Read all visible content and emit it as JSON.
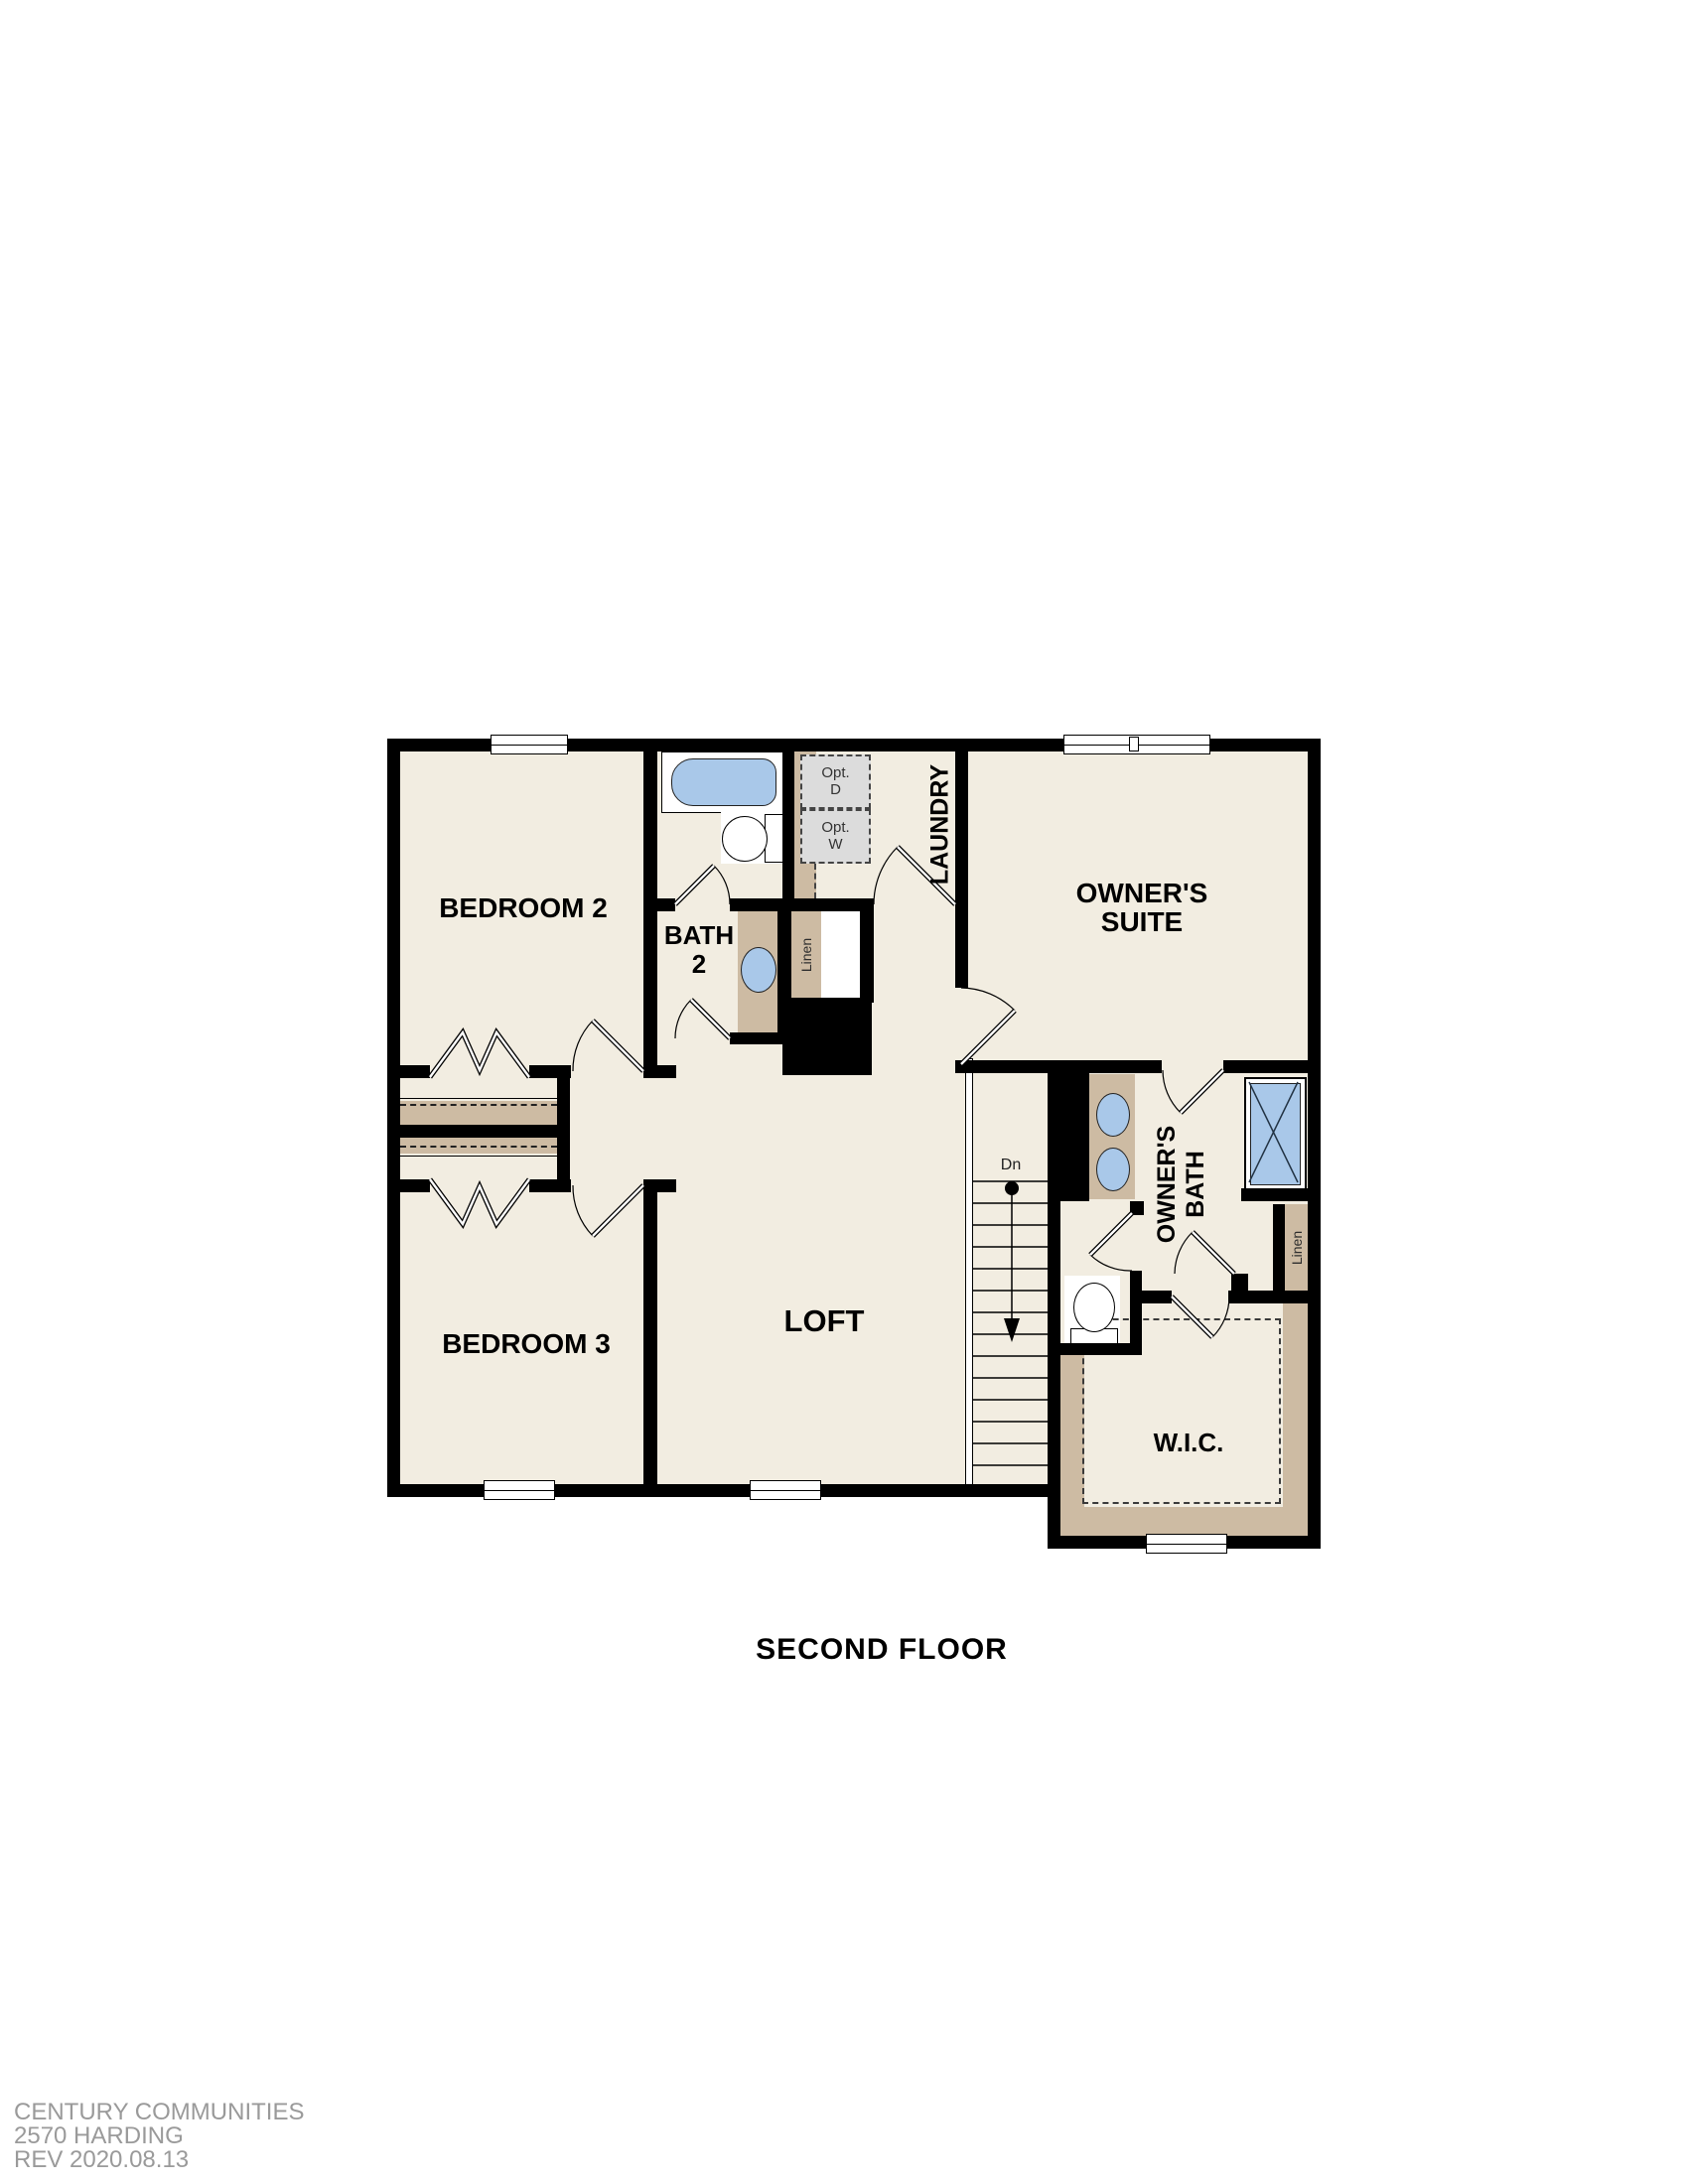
{
  "title": "SECOND FLOOR",
  "rooms": {
    "bedroom2": "BEDROOM 2",
    "bath2": "BATH 2",
    "laundry": "LAUNDRY",
    "owners_suite": "OWNER'S SUITE",
    "bedroom3": "BEDROOM 3",
    "loft": "LOFT",
    "owners_bath": "OWNER'S BATH",
    "wic": "W.I.C."
  },
  "closets": {
    "linen_bath2": "Linen",
    "linen_owners": "Linen"
  },
  "stairs": {
    "down_label": "Dn"
  },
  "options": {
    "opt_dryer": "Opt.\nD",
    "opt_washer": "Opt.\nW"
  },
  "footer": {
    "line1": "CENTURY COMMUNITIES",
    "line2": "2570 HARDING",
    "line3": "REV 2020.08.13"
  },
  "colors": {
    "floor_cream": "#f2ede1",
    "cabinet_tan": "#cdbba3",
    "fixture_blue": "#a9c8e9",
    "option_gray": "#dcdcdc",
    "wall_black": "#000000",
    "footer_gray": "#9a9a9a"
  }
}
